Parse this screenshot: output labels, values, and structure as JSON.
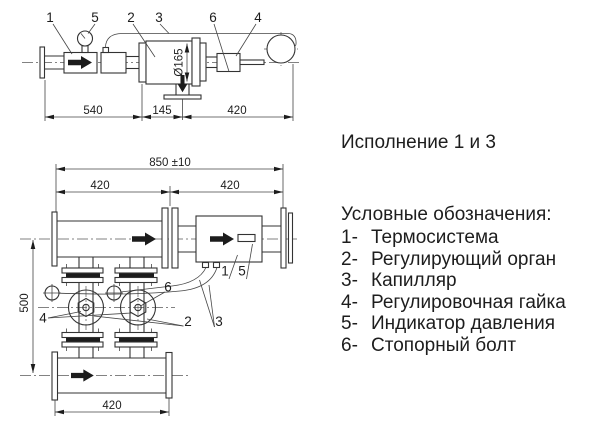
{
  "execution_note": "Исполнение 1 и 3",
  "legend": {
    "heading": "Условные обозначения:",
    "items": [
      {
        "num": "1-",
        "label": "Термосистема"
      },
      {
        "num": "2-",
        "label": "Регулирующий орган"
      },
      {
        "num": "3-",
        "label": "Капилляр"
      },
      {
        "num": "4-",
        "label": "Регулировочная гайка"
      },
      {
        "num": "5-",
        "label": "Индикатор давления"
      },
      {
        "num": "6-",
        "label": "Стопорный болт"
      }
    ]
  },
  "top_view": {
    "callouts": {
      "c1": "1",
      "c2": "2",
      "c3": "3",
      "c4": "4",
      "c5": "5",
      "c6": "6"
    },
    "dims": {
      "d540": "540",
      "d145": "145",
      "d420": "420",
      "diameter": "Ø165"
    }
  },
  "bottom_view": {
    "callouts": {
      "c1": "1",
      "c2": "2",
      "c3": "3",
      "c4": "4",
      "c5": "5",
      "c6": "6"
    },
    "dims": {
      "overall": "850 ±10",
      "left": "420",
      "right": "420",
      "height": "500",
      "bottom": "420"
    }
  },
  "colors": {
    "background": "#ffffff",
    "line": "#333333",
    "text": "#1d1d1d",
    "flow_arrow": "#1c1c1c"
  }
}
